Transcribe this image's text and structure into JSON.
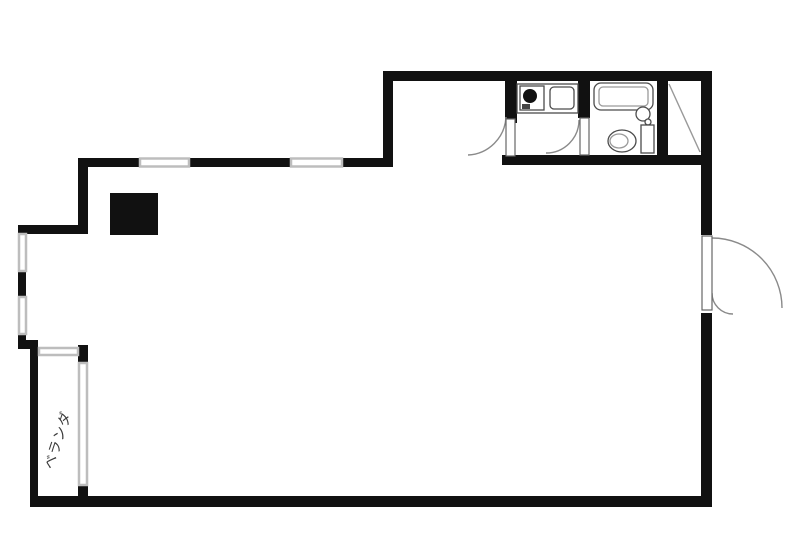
{
  "labels": {
    "veranda": "ベランダ"
  },
  "colors": {
    "wall": "#111111",
    "window": "#bdbdbd",
    "fixture": "#4c4c4c",
    "fixture_light": "#9a9a9a",
    "door_arc": "#8a8a8a",
    "background": "#ffffff"
  },
  "elements": {
    "plan": "studio-apartment-floor-plan",
    "kitchen_counter": "kitchen-counter",
    "stove": "stove-burner",
    "sink": "kitchen-sink",
    "bathtub": "bathtub",
    "shower": "shower-mixer",
    "toilet": "toilet",
    "closet": "closet-diagonal-mark",
    "entrance": "entrance-double-door",
    "pillar": "pillar-black-block",
    "windows": "window-segments",
    "veranda_window": "veranda-sliding-window"
  }
}
